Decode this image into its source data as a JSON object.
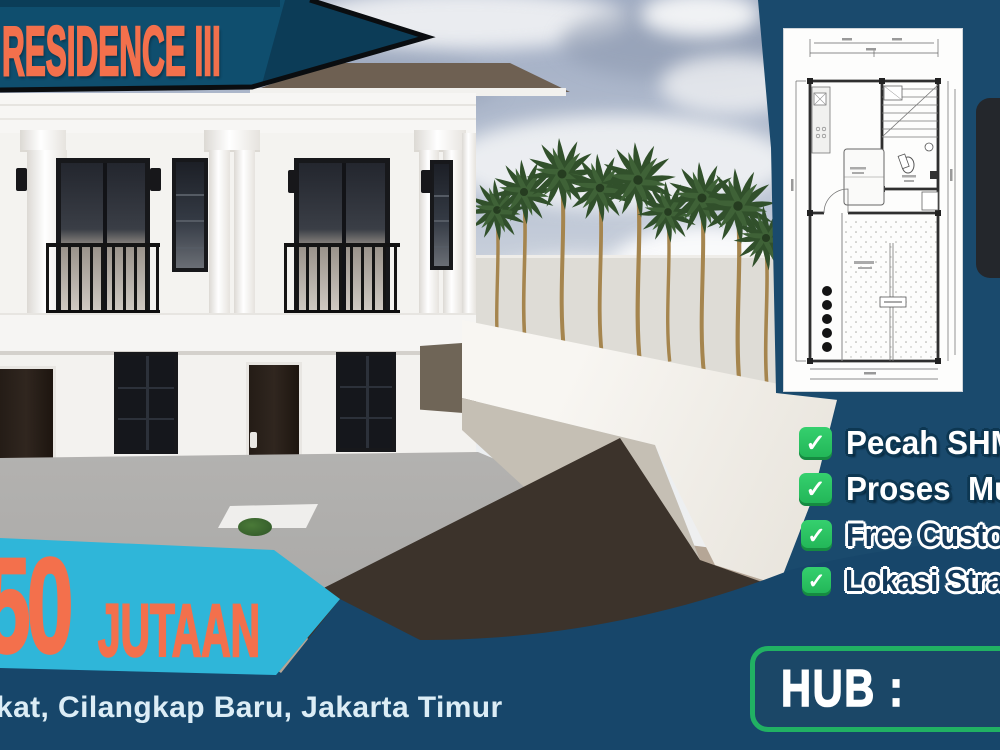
{
  "top_banner": {
    "title": "RESIDENCE III"
  },
  "price_banner": {
    "amount": "50",
    "unit": "JUTAAN"
  },
  "address": {
    "visible_text": "kat, Cilangkap Baru, Jakarta Timur"
  },
  "features": {
    "check_glyph": "✓",
    "items": [
      {
        "label": "Pecah SHM"
      },
      {
        "label": "Proses  Mu"
      },
      {
        "label": "Free Custo"
      },
      {
        "label": "Lokasi Stra"
      }
    ]
  },
  "contact": {
    "label": "HUB :"
  },
  "floor_plan": {
    "name": "site-floor-plan-drawing"
  },
  "colors": {
    "banner_navy": "#0f4e6e",
    "panel_navy": "#1a4a6d",
    "footer_navy": "#17466a",
    "cyan": "#2fb6d9",
    "orange": "#f3704c",
    "check_green": "#29c362",
    "hub_border_green": "#21b163"
  }
}
